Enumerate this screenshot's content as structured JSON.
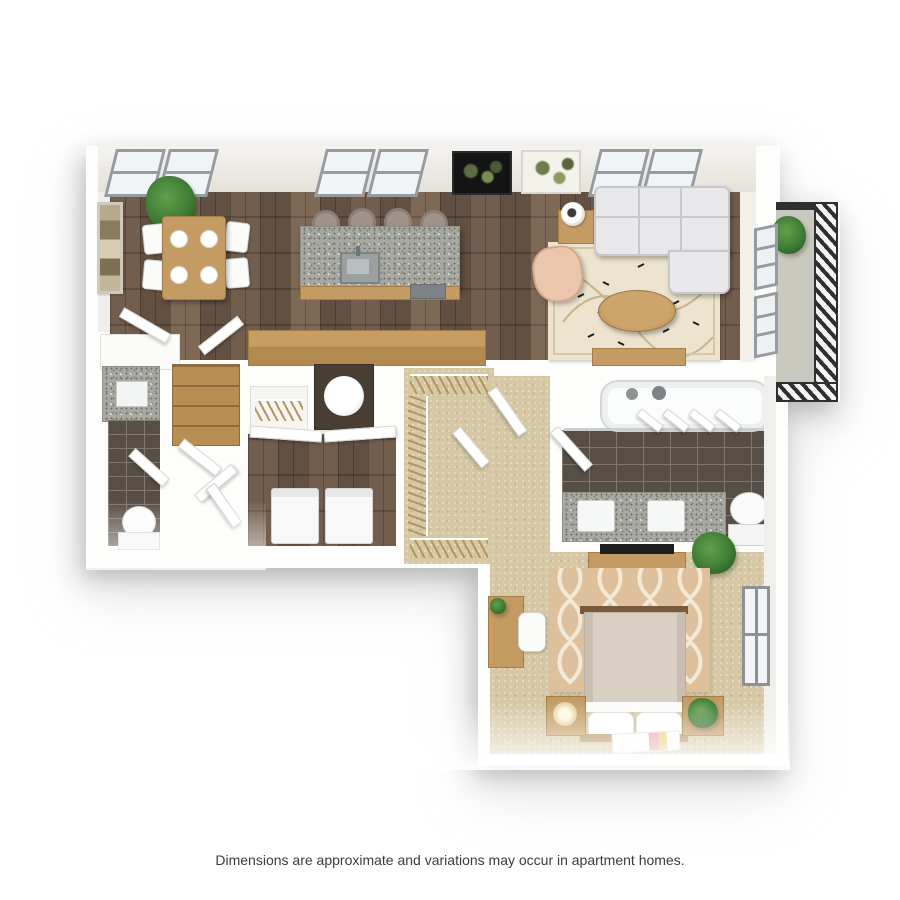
{
  "page": {
    "disclaimer": "Dimensions are approximate and variations may occur in apartment homes."
  },
  "floorplan": {
    "type": "3d-top-down-apartment-floor-plan",
    "rooms": [
      "dining-area",
      "kitchen",
      "living-room",
      "balcony",
      "bathroom-1",
      "laundry-closet",
      "walk-in-closet",
      "hallway",
      "bathroom-2",
      "bedroom"
    ]
  },
  "colors": {
    "page_bg": "#ffffff",
    "wall_white": "#fdfdfb",
    "wood_floor_dark": "#5a4738",
    "wood_floor_mid": "#6b5545",
    "wood_floor_light": "#77614d",
    "furniture_wood": "#c49b63",
    "granite": "#a9a9a3",
    "tile_dark": "#574e45",
    "tile_grout": "#80786e",
    "carpet": "#d6c8a5",
    "rug_bedroom": "#dfc09d",
    "rug_trellis": "#f2ead6",
    "rug_living": "#ece4cf",
    "sofa": "#e8e8ea",
    "armchair": "#ebc6ac",
    "balcony_floor": "#c9c9bf",
    "railing_dark": "#2d2f31",
    "plant_green": "#3c7a33",
    "appliance_white": "#f7f8f7",
    "text_color": "#3c3c3c"
  }
}
